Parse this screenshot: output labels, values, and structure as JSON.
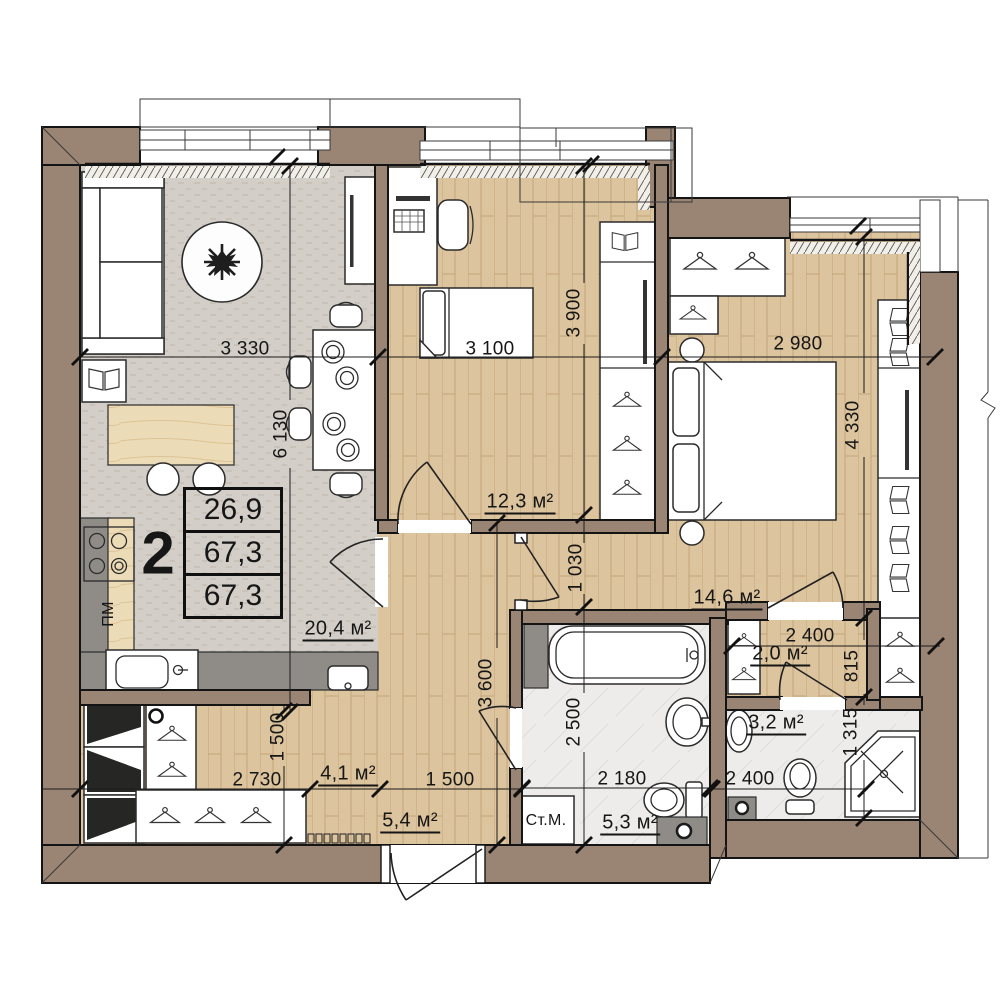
{
  "info_box": {
    "rooms_count": "2",
    "rows": [
      "26,9",
      "67,3",
      "67,3"
    ]
  },
  "area_labels": [
    {
      "id": "living-kitchen",
      "text": "20,4 м²"
    },
    {
      "id": "bedroom-2",
      "text": "12,3 м²"
    },
    {
      "id": "bedroom-1",
      "text": "14,6 м²"
    },
    {
      "id": "wardrobe",
      "text": "2,0 м²"
    },
    {
      "id": "bathroom-2",
      "text": "3,2 м²"
    },
    {
      "id": "hallway",
      "text": "4,1 м²"
    },
    {
      "id": "corridor",
      "text": "5,4 м²"
    },
    {
      "id": "bathroom-1",
      "text": "5,3 м²"
    }
  ],
  "dimensions": [
    {
      "id": "top-living",
      "text": "3 330"
    },
    {
      "id": "top-bedroom2",
      "text": "3 100"
    },
    {
      "id": "top-bedroom1",
      "text": "2 980"
    },
    {
      "id": "living-depth",
      "text": "6 130"
    },
    {
      "id": "bedroom2-depth",
      "text": "3 900"
    },
    {
      "id": "passage",
      "text": "1 030"
    },
    {
      "id": "bathroom1-depth",
      "text": "2 500"
    },
    {
      "id": "corridor-depth",
      "text": "3 600"
    },
    {
      "id": "bedroom1-depth",
      "text": "4 330"
    },
    {
      "id": "wardrobe-depth",
      "text": "815"
    },
    {
      "id": "bathroom2-depth",
      "text": "1 315"
    },
    {
      "id": "hall-depth",
      "text": "1 500"
    },
    {
      "id": "hall-width",
      "text": "2 730"
    },
    {
      "id": "corridor-width",
      "text": "1 500"
    },
    {
      "id": "bathroom1-width",
      "text": "2 180"
    },
    {
      "id": "wardrobe-width",
      "text": "2 400"
    },
    {
      "id": "bathroom2-width",
      "text": "2 400"
    }
  ],
  "equipment": {
    "dishwasher": "ПМ",
    "washing_machine": "Ст.М."
  },
  "colors": {
    "wall": "#9a8474",
    "wood_floor": "#dcc49e",
    "carpet": "#d3cec7",
    "tile_floor": "#edecea",
    "kitchen_counter": "#ecdbb7",
    "counter_gray": "#8f8c88",
    "line": "#1c1c1c"
  }
}
